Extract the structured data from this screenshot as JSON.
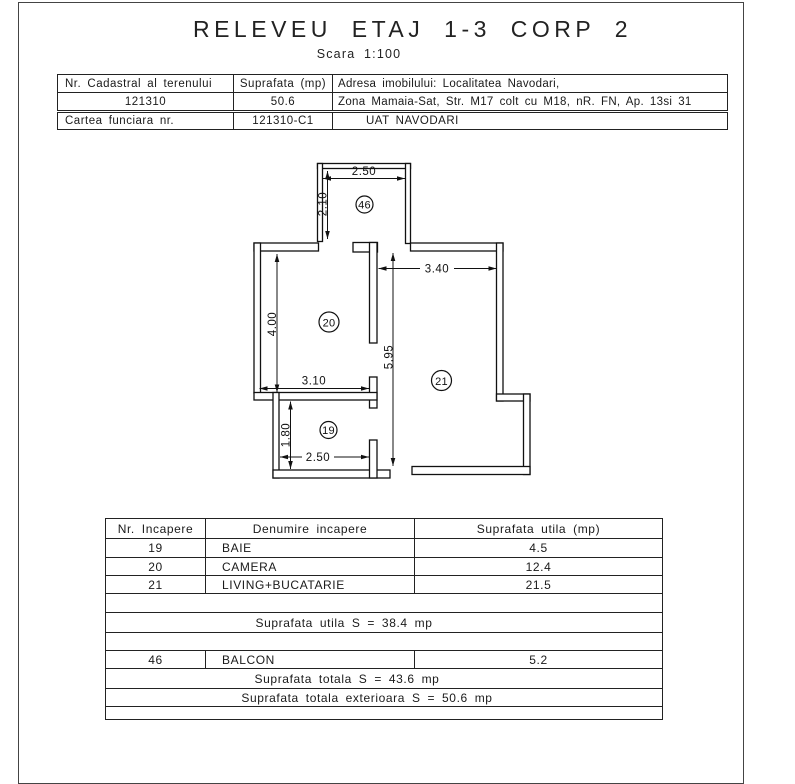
{
  "title": "RELEVEU ETAJ 1-3 CORP 2",
  "scale_label": "Scara 1:100",
  "header_table": {
    "row1": {
      "c1": "Nr. Cadastral al terenului",
      "c2": "Suprafata (mp)",
      "c3": "Adresa imobilului: Localitatea Navodari,"
    },
    "row2": {
      "c1": "121310",
      "c2": "50.6",
      "c3": "Zona Mamaia-Sat, Str. M17 colt cu M18, nR. FN, Ap. 13si 31"
    },
    "row3": {
      "c1": "Cartea funciara nr.",
      "c2": "121310-C1",
      "c3": "UAT NAVODARI"
    }
  },
  "floor_plan": {
    "dimensions": {
      "balcony_width": "2.50",
      "balcony_depth": "2.10",
      "living_width": "3.40",
      "apartment_depth": "5.95",
      "camera_depth": "4.00",
      "camera_width": "3.10",
      "baie_depth": "1.80",
      "baie_width": "2.50"
    },
    "room_labels": {
      "balcon": "46",
      "camera": "20",
      "living": "21",
      "baie": "19"
    }
  },
  "rooms_table": {
    "headers": {
      "nr": "Nr. Incapere",
      "name": "Denumire incapere",
      "area": "Suprafata utila (mp)"
    },
    "rows": [
      {
        "nr": "19",
        "name": "BAIE",
        "area": "4.5"
      },
      {
        "nr": "20",
        "name": "CAMERA",
        "area": "12.4"
      },
      {
        "nr": "21",
        "name": "LIVING+BUCATARIE",
        "area": "21.5"
      }
    ],
    "subtotal": "Suprafata utila S = 38.4 mp",
    "balcony_row": {
      "nr": "46",
      "name": "BALCON",
      "area": "5.2"
    },
    "total": "Suprafata totala S = 43.6 mp",
    "total_exterior": "Suprafata totala exterioara S = 50.6 mp"
  }
}
